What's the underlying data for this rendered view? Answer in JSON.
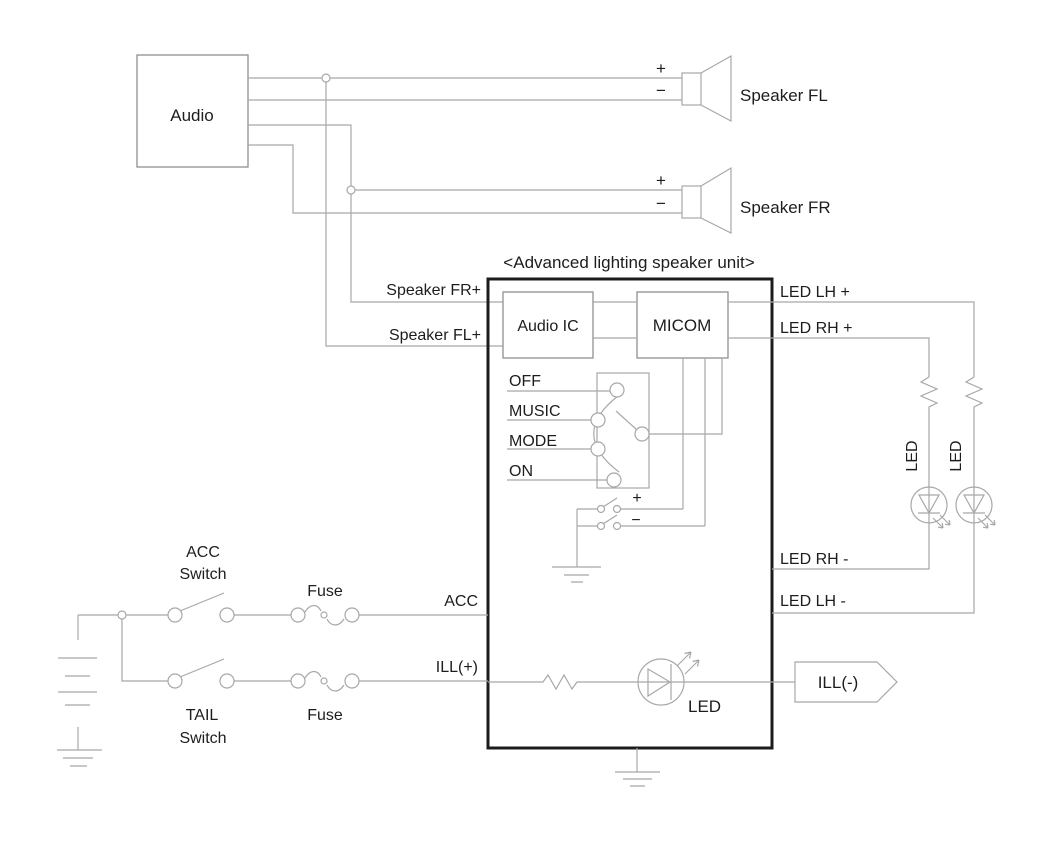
{
  "title": "<Advanced lighting speaker unit>",
  "colors": {
    "background": "#ffffff",
    "wire": "#a8a8a8",
    "unit_border": "#1c1c1c",
    "text": "#1d1d1d"
  },
  "audio": {
    "label": "Audio"
  },
  "speakers": {
    "fl": "Speaker FL",
    "fr": "Speaker FR",
    "plus": "+",
    "minus": "−"
  },
  "unit": {
    "audio_ic": "Audio IC",
    "micom": "MICOM",
    "mode_switch": {
      "positions": [
        "OFF",
        "MUSIC",
        "MODE",
        "ON"
      ]
    },
    "power_switch": {
      "plus": "+",
      "minus": "−"
    },
    "inner_led": "LED"
  },
  "left_labels": {
    "speaker_fr_plus": "Speaker FR+",
    "speaker_fl_plus": "Speaker FL+",
    "acc": "ACC",
    "ill_plus": "ILL(+)"
  },
  "right_labels": {
    "led_lh_plus": "LED LH +",
    "led_rh_plus": "LED RH +",
    "led_rh_minus": "LED RH -",
    "led_lh_minus": "LED LH -",
    "ill_minus": "ILL(-)",
    "led_rh_vertical": "LED",
    "led_lh_vertical": "LED"
  },
  "power": {
    "acc_switch_line1": "ACC",
    "acc_switch_line2": "Switch",
    "tail_switch_line1": "TAIL",
    "tail_switch_line2": "Switch",
    "fuse_top": "Fuse",
    "fuse_bottom": "Fuse"
  }
}
